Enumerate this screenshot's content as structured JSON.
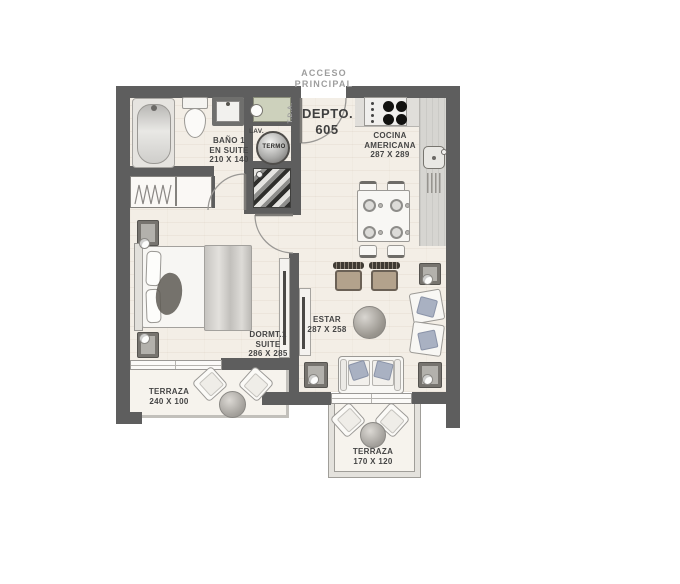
{
  "plan": {
    "entry": {
      "access_line1": "ACCESO",
      "access_line2": "PRINCIPAL",
      "unit_label": "DEPTO.",
      "unit_number": "605",
      "panel_label": "T.D.A."
    },
    "rooms": {
      "bathroom": {
        "name_line1": "BAÑO 1",
        "name_line2": "EN SUITE",
        "dimensions": "210 X 140"
      },
      "kitchen": {
        "name_line1": "COCINA",
        "name_line2": "AMERICANA",
        "dimensions": "287 X 289"
      },
      "bedroom": {
        "name_line1": "DORMT.1",
        "name_line2": "SUITE",
        "dimensions": "286 X 285"
      },
      "living": {
        "name_line1": "ESTAR",
        "dimensions": "287 X 258"
      },
      "terrace_bedroom": {
        "name_line1": "TERRAZA",
        "dimensions": "240 X 100"
      },
      "terrace_living": {
        "name_line1": "TERRAZA",
        "dimensions": "170 X 120"
      }
    },
    "fixtures": {
      "laundry_label": "LAV.",
      "heater_label": "TERMO"
    },
    "colors": {
      "wall": "#5e5e5e",
      "floor": "#f3eee6",
      "terrace_floor": "#f6f3ed",
      "counter": "#d6d5d1",
      "cabinet_green": "#cdd1bc",
      "label_dark": "#454545",
      "label_gray": "#9e9e9e"
    }
  }
}
